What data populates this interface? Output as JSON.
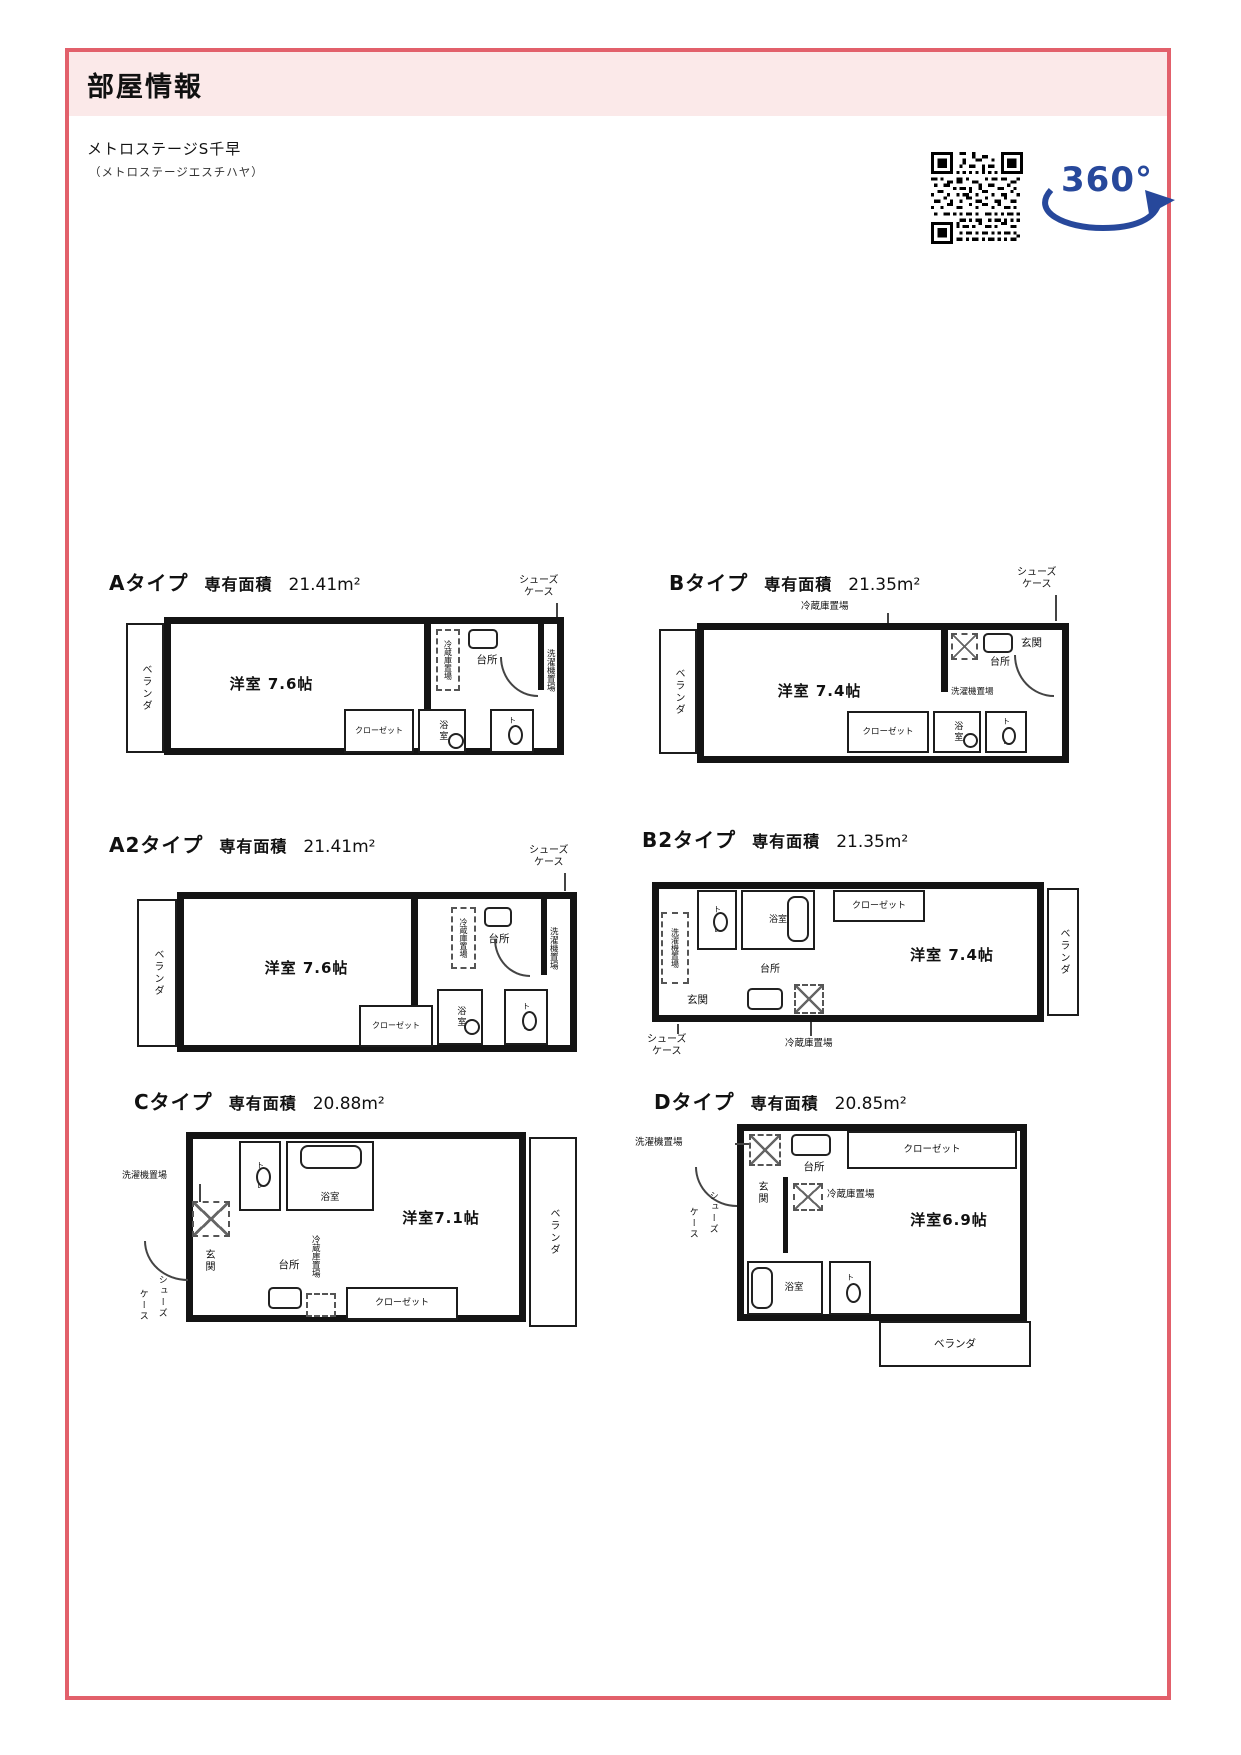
{
  "header": {
    "title": "部屋情報"
  },
  "property": {
    "name": "メトロステージS千早",
    "kana": "（メトロステージエスチハヤ）"
  },
  "badge_360": {
    "text": "360°"
  },
  "shared": {
    "area_label": "専有面積"
  },
  "colors": {
    "accent": "#e2606b",
    "header_bg": "#fbe9e9",
    "badge_blue": "#27489b",
    "plan_ink": "#141414"
  },
  "plans": [
    {
      "id": "A",
      "type_label": "Aタイプ",
      "area_value": "21.41m²",
      "labels": {
        "veranda": "ベランダ",
        "main": "洋室 7.6帖",
        "closet": "クローゼット",
        "bath": "浴室",
        "toilet": "トイレ",
        "kitchen": "台所",
        "fridge": "冷蔵庫置場",
        "laundry": "洗濯機置場",
        "shoes1": "シューズ",
        "shoes2": "ケース"
      }
    },
    {
      "id": "B",
      "type_label": "Bタイプ",
      "area_value": "21.35m²",
      "labels": {
        "veranda": "ベランダ",
        "main": "洋室 7.4帖",
        "closet": "クローゼット",
        "bath": "浴室",
        "toilet": "トイレ",
        "kitchen": "台所",
        "fridge": "冷蔵庫置場",
        "laundry": "洗濯機置場",
        "entrance": "玄関",
        "shoes1": "シューズ",
        "shoes2": "ケース"
      }
    },
    {
      "id": "A2",
      "type_label": "A2タイプ",
      "area_value": "21.41m²",
      "labels": {
        "veranda": "ベランダ",
        "main": "洋室 7.6帖",
        "closet": "クローゼット",
        "bath": "浴室",
        "toilet": "トイレ",
        "kitchen": "台所",
        "fridge": "冷蔵庫置場",
        "laundry": "洗濯機置場",
        "shoes1": "シューズ",
        "shoes2": "ケース"
      }
    },
    {
      "id": "B2",
      "type_label": "B2タイプ",
      "area_value": "21.35m²",
      "labels": {
        "veranda": "ベランダ",
        "main": "洋室 7.4帖",
        "closet": "クローゼット",
        "bath": "浴室",
        "toilet": "トイレ",
        "kitchen": "台所",
        "fridge": "冷蔵庫置場",
        "laundry": "洗濯機置場",
        "entrance": "玄関",
        "shoes1": "シューズ",
        "shoes2": "ケース"
      }
    },
    {
      "id": "C",
      "type_label": "Cタイプ",
      "area_value": "20.88m²",
      "labels": {
        "veranda": "ベランダ",
        "main": "洋室7.1帖",
        "closet": "クローゼット",
        "bath": "浴室",
        "toilet": "トイレ",
        "kitchen": "台所",
        "fridge": "冷蔵庫置場",
        "laundry": "洗濯機置場",
        "entrance": "玄関",
        "shoes1": "シューズ",
        "shoes2": "ケース"
      }
    },
    {
      "id": "D",
      "type_label": "Dタイプ",
      "area_value": "20.85m²",
      "labels": {
        "veranda": "ベランダ",
        "main": "洋室6.9帖",
        "closet": "クローゼット",
        "bath": "浴室",
        "toilet": "トイレ",
        "kitchen": "台所",
        "fridge": "冷蔵庫置場",
        "laundry": "洗濯機置場",
        "entrance": "玄関",
        "shoes1": "シューズ",
        "shoes2": "ケース"
      }
    }
  ]
}
